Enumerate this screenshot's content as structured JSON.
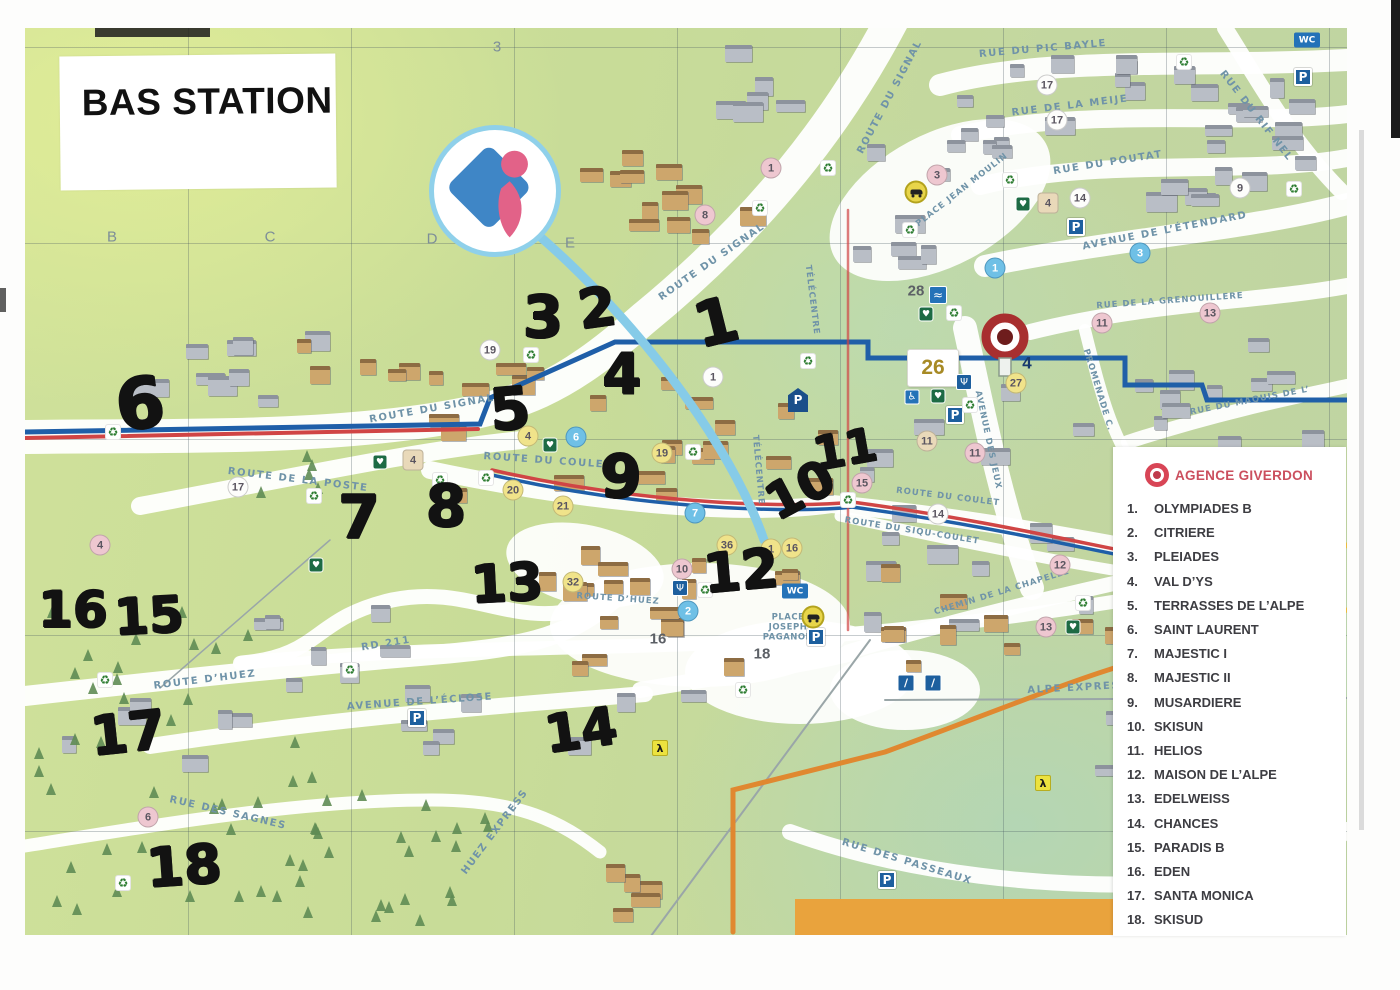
{
  "title": "BAS STATION",
  "legend": {
    "agency_name": "AGENCE GIVERDON",
    "accent_color": "#cb4f5e",
    "items": [
      {
        "num": "1.",
        "label": "OLYMPIADES B"
      },
      {
        "num": "2.",
        "label": "CITRIERE"
      },
      {
        "num": "3.",
        "label": "PLEIADES"
      },
      {
        "num": "4.",
        "label": "VAL D’YS"
      },
      {
        "num": "5.",
        "label": "TERRASSES DE L’ALPE"
      },
      {
        "num": "6.",
        "label": "SAINT LAURENT"
      },
      {
        "num": "7.",
        "label": "MAJESTIC I"
      },
      {
        "num": "8.",
        "label": "MAJESTIC II"
      },
      {
        "num": "9.",
        "label": "MUSARDIERE"
      },
      {
        "num": "10.",
        "label": "SKISUN"
      },
      {
        "num": "11.",
        "label": "HELIOS"
      },
      {
        "num": "12.",
        "label": "MAISON DE L’ALPE"
      },
      {
        "num": "13.",
        "label": "EDELWEISS"
      },
      {
        "num": "14.",
        "label": "CHANCES"
      },
      {
        "num": "15.",
        "label": "PARADIS B"
      },
      {
        "num": "16.",
        "label": "EDEN"
      },
      {
        "num": "17.",
        "label": "SANTA MONICA"
      },
      {
        "num": "18.",
        "label": "SKISUD"
      }
    ]
  },
  "grid_labels": [
    {
      "t": "3",
      "x": 497,
      "y": 47
    },
    {
      "t": "B",
      "x": 112,
      "y": 237
    },
    {
      "t": "C",
      "x": 270,
      "y": 237
    },
    {
      "t": "D",
      "x": 432,
      "y": 239
    },
    {
      "t": "E",
      "x": 570,
      "y": 243
    }
  ],
  "streets": [
    {
      "name": "ROUTE DU SIGNAL",
      "x": 890,
      "y": 97,
      "rot": -62
    },
    {
      "name": "ROUTE DU SIGNAL",
      "x": 712,
      "y": 262,
      "rot": -35
    },
    {
      "name": "ROUTE DU SIGNAL",
      "x": 432,
      "y": 409,
      "rot": -10
    },
    {
      "name": "RUE DU PIC BAYLE",
      "x": 1043,
      "y": 49,
      "rot": -5
    },
    {
      "name": "RUE DE LA MEIJE",
      "x": 1070,
      "y": 106,
      "rot": -7
    },
    {
      "name": "RUE DU POUTAT",
      "x": 1108,
      "y": 163,
      "rot": -9
    },
    {
      "name": "RUE DU RIF NEL",
      "x": 1256,
      "y": 116,
      "rot": 52
    },
    {
      "name": "AVENUE DE L’ÉTENDARD",
      "x": 1165,
      "y": 231,
      "rot": -11
    },
    {
      "name": "PLACE JEAN MOULIN",
      "x": 962,
      "y": 190,
      "rot": -38,
      "small": true
    },
    {
      "name": "RUE DE LA GRENOUILLERE",
      "x": 1170,
      "y": 301,
      "rot": -4,
      "small": true
    },
    {
      "name": "PROMENADE C.",
      "x": 1098,
      "y": 390,
      "rot": 73,
      "small": true
    },
    {
      "name": "RUE DU MAQUIS DE L’",
      "x": 1250,
      "y": 401,
      "rot": -11,
      "small": true
    },
    {
      "name": "AVENUE DES JEUX",
      "x": 988,
      "y": 440,
      "rot": 78,
      "small": true
    },
    {
      "name": "TÉLÉCENTRE",
      "x": 812,
      "y": 300,
      "rot": 83,
      "small": true
    },
    {
      "name": "TÉLÉCENTRE",
      "x": 758,
      "y": 470,
      "rot": 85,
      "small": true
    },
    {
      "name": "ROUTE DU COULET",
      "x": 548,
      "y": 461,
      "rot": 4
    },
    {
      "name": "ROUTE DU COULET",
      "x": 948,
      "y": 497,
      "rot": 7,
      "small": true
    },
    {
      "name": "ROUTE DU SIQU-COULET",
      "x": 912,
      "y": 531,
      "rot": 9,
      "small": true
    },
    {
      "name": "CHEMIN DE LA CHAPELLE",
      "x": 1002,
      "y": 592,
      "rot": -17,
      "small": true
    },
    {
      "name": "ROUTE DE LA POSTE",
      "x": 298,
      "y": 480,
      "rot": 7
    },
    {
      "name": "ROUTE D’HUEZ",
      "x": 205,
      "y": 680,
      "rot": -7
    },
    {
      "name": "ROUTE D’HUEZ",
      "x": 618,
      "y": 599,
      "rot": 4,
      "small": true
    },
    {
      "name": "RD 211",
      "x": 386,
      "y": 644,
      "rot": -9
    },
    {
      "name": "AVENUE DE L’ÉCLOSE",
      "x": 420,
      "y": 702,
      "rot": -4
    },
    {
      "name": "RUE DES SAGNES",
      "x": 228,
      "y": 813,
      "rot": 13
    },
    {
      "name": "HUEZ EXPRESS",
      "x": 495,
      "y": 832,
      "rot": -53
    },
    {
      "name": "ALPE EXPRESS",
      "x": 1078,
      "y": 688,
      "rot": -3
    },
    {
      "name": "RUE DES PASSEAUX",
      "x": 907,
      "y": 862,
      "rot": 17
    },
    {
      "name": "PLACE JOSEPH PAGANON",
      "x": 788,
      "y": 628,
      "rot": 0,
      "small": true,
      "wrap": true
    }
  ],
  "handwritten_numbers": [
    {
      "n": "3",
      "x": 543,
      "y": 317,
      "size": 58,
      "rot": 0
    },
    {
      "n": "2",
      "x": 597,
      "y": 308,
      "size": 54,
      "rot": -8
    },
    {
      "n": "1",
      "x": 716,
      "y": 322,
      "size": 62,
      "rot": -14
    },
    {
      "n": "4",
      "x": 622,
      "y": 375,
      "size": 56,
      "rot": 0
    },
    {
      "n": "5",
      "x": 510,
      "y": 409,
      "size": 58,
      "rot": -5
    },
    {
      "n": "6",
      "x": 140,
      "y": 404,
      "size": 70,
      "rot": -8
    },
    {
      "n": "9",
      "x": 621,
      "y": 477,
      "size": 60,
      "rot": 0
    },
    {
      "n": "7",
      "x": 359,
      "y": 518,
      "size": 60,
      "rot": 0
    },
    {
      "n": "8",
      "x": 446,
      "y": 506,
      "size": 58,
      "rot": 0
    },
    {
      "n": "10",
      "x": 800,
      "y": 490,
      "size": 50,
      "rot": -28
    },
    {
      "n": "11",
      "x": 845,
      "y": 449,
      "size": 46,
      "rot": -10
    },
    {
      "n": "12",
      "x": 741,
      "y": 571,
      "size": 54,
      "rot": -5
    },
    {
      "n": "13",
      "x": 507,
      "y": 584,
      "size": 52,
      "rot": -3
    },
    {
      "n": "16",
      "x": 73,
      "y": 610,
      "size": 50,
      "rot": 0
    },
    {
      "n": "15",
      "x": 149,
      "y": 616,
      "size": 50,
      "rot": -3
    },
    {
      "n": "17",
      "x": 128,
      "y": 733,
      "size": 54,
      "rot": -6
    },
    {
      "n": "14",
      "x": 581,
      "y": 731,
      "size": 52,
      "rot": -8
    },
    {
      "n": "18",
      "x": 184,
      "y": 866,
      "size": 54,
      "rot": -4
    }
  ],
  "markers": [
    {
      "n": "4",
      "x": 528,
      "y": 436,
      "s": "y"
    },
    {
      "n": "19",
      "x": 662,
      "y": 453,
      "s": "y"
    },
    {
      "n": "20",
      "x": 513,
      "y": 490,
      "s": "y"
    },
    {
      "n": "21",
      "x": 563,
      "y": 506,
      "s": "y"
    },
    {
      "n": "36",
      "x": 727,
      "y": 545,
      "s": "y"
    },
    {
      "n": "1",
      "x": 771,
      "y": 549,
      "s": "y"
    },
    {
      "n": "16",
      "x": 792,
      "y": 548,
      "s": "y"
    },
    {
      "n": "27",
      "x": 1016,
      "y": 383,
      "s": "y"
    },
    {
      "n": "32",
      "x": 573,
      "y": 582,
      "s": "y"
    },
    {
      "n": "8",
      "x": 705,
      "y": 215,
      "s": "p"
    },
    {
      "n": "1",
      "x": 771,
      "y": 168,
      "s": "p"
    },
    {
      "n": "3",
      "x": 937,
      "y": 175,
      "s": "p"
    },
    {
      "n": "4",
      "x": 100,
      "y": 545,
      "s": "p"
    },
    {
      "n": "10",
      "x": 682,
      "y": 569,
      "s": "p"
    },
    {
      "n": "11",
      "x": 975,
      "y": 453,
      "s": "p"
    },
    {
      "n": "12",
      "x": 1060,
      "y": 565,
      "s": "p"
    },
    {
      "n": "13",
      "x": 1046,
      "y": 627,
      "s": "p"
    },
    {
      "n": "13",
      "x": 1210,
      "y": 313,
      "s": "p"
    },
    {
      "n": "11",
      "x": 1102,
      "y": 323,
      "s": "p"
    },
    {
      "n": "15",
      "x": 862,
      "y": 483,
      "s": "p"
    },
    {
      "n": "6",
      "x": 148,
      "y": 817,
      "s": "p"
    },
    {
      "n": "17",
      "x": 238,
      "y": 487,
      "s": "w"
    },
    {
      "n": "4",
      "x": 413,
      "y": 460,
      "s": "tsq"
    },
    {
      "n": "4",
      "x": 1048,
      "y": 203,
      "s": "tsq"
    },
    {
      "n": "11",
      "x": 927,
      "y": 441,
      "s": "t"
    },
    {
      "n": "14",
      "x": 938,
      "y": 514,
      "s": "w"
    },
    {
      "n": "1",
      "x": 995,
      "y": 268,
      "s": "b"
    },
    {
      "n": "3",
      "x": 1140,
      "y": 253,
      "s": "b"
    },
    {
      "n": "6",
      "x": 576,
      "y": 437,
      "s": "b"
    },
    {
      "n": "2",
      "x": 688,
      "y": 611,
      "s": "b"
    },
    {
      "n": "7",
      "x": 695,
      "y": 513,
      "s": "b"
    },
    {
      "n": "19",
      "x": 490,
      "y": 350,
      "s": "w"
    },
    {
      "n": "17",
      "x": 1047,
      "y": 85,
      "s": "w"
    },
    {
      "n": "17",
      "x": 1057,
      "y": 120,
      "s": "w"
    },
    {
      "n": "14",
      "x": 1080,
      "y": 198,
      "s": "w"
    },
    {
      "n": "9",
      "x": 1240,
      "y": 188,
      "s": "w"
    },
    {
      "n": "1",
      "x": 713,
      "y": 377,
      "s": "w"
    },
    {
      "n": "28",
      "x": 916,
      "y": 291,
      "s": "g"
    },
    {
      "n": "16",
      "x": 658,
      "y": 639,
      "s": "g"
    },
    {
      "n": "18",
      "x": 762,
      "y": 654,
      "s": "g"
    },
    {
      "n": "4",
      "x": 1027,
      "y": 363,
      "s": "navy"
    },
    {
      "n": "26",
      "x": 933,
      "y": 368,
      "s": "sign"
    }
  ],
  "icons": [
    {
      "type": "parking",
      "glyph": "P",
      "x": 1303,
      "y": 77
    },
    {
      "type": "parking",
      "glyph": "P",
      "x": 1076,
      "y": 227
    },
    {
      "type": "parking",
      "glyph": "P",
      "x": 955,
      "y": 415
    },
    {
      "type": "parking",
      "glyph": "P",
      "x": 816,
      "y": 637
    },
    {
      "type": "parking",
      "glyph": "P",
      "x": 417,
      "y": 718
    },
    {
      "type": "parking",
      "glyph": "P",
      "x": 887,
      "y": 880
    },
    {
      "type": "parking-sign",
      "glyph": "P",
      "x": 798,
      "y": 400
    },
    {
      "type": "wc",
      "glyph": "WC",
      "x": 1307,
      "y": 40
    },
    {
      "type": "wc",
      "glyph": "WC",
      "x": 795,
      "y": 591
    },
    {
      "type": "recycle",
      "glyph": "♻",
      "x": 113,
      "y": 432
    },
    {
      "type": "recycle",
      "glyph": "♻",
      "x": 314,
      "y": 496
    },
    {
      "type": "recycle",
      "glyph": "♻",
      "x": 440,
      "y": 480
    },
    {
      "type": "recycle",
      "glyph": "♻",
      "x": 531,
      "y": 355
    },
    {
      "type": "recycle",
      "glyph": "♻",
      "x": 486,
      "y": 478
    },
    {
      "type": "recycle",
      "glyph": "♻",
      "x": 828,
      "y": 168
    },
    {
      "type": "recycle",
      "glyph": "♻",
      "x": 760,
      "y": 208
    },
    {
      "type": "recycle",
      "glyph": "♻",
      "x": 910,
      "y": 230
    },
    {
      "type": "recycle",
      "glyph": "♻",
      "x": 1184,
      "y": 62
    },
    {
      "type": "recycle",
      "glyph": "♻",
      "x": 1294,
      "y": 189
    },
    {
      "type": "recycle",
      "glyph": "♻",
      "x": 1010,
      "y": 180
    },
    {
      "type": "recycle",
      "glyph": "♻",
      "x": 954,
      "y": 313
    },
    {
      "type": "recycle",
      "glyph": "♻",
      "x": 970,
      "y": 405
    },
    {
      "type": "recycle",
      "glyph": "♻",
      "x": 1083,
      "y": 603
    },
    {
      "type": "recycle",
      "glyph": "♻",
      "x": 848,
      "y": 500
    },
    {
      "type": "recycle",
      "glyph": "♻",
      "x": 705,
      "y": 590
    },
    {
      "type": "recycle",
      "glyph": "♻",
      "x": 743,
      "y": 690
    },
    {
      "type": "recycle",
      "glyph": "♻",
      "x": 350,
      "y": 670
    },
    {
      "type": "recycle",
      "glyph": "♻",
      "x": 105,
      "y": 680
    },
    {
      "type": "recycle",
      "glyph": "♻",
      "x": 123,
      "y": 883
    },
    {
      "type": "recycle",
      "glyph": "♻",
      "x": 693,
      "y": 452
    },
    {
      "type": "recycle",
      "glyph": "♻",
      "x": 808,
      "y": 361
    },
    {
      "type": "defib",
      "glyph": "♥",
      "x": 380,
      "y": 462
    },
    {
      "type": "defib",
      "glyph": "♥",
      "x": 550,
      "y": 445
    },
    {
      "type": "defib",
      "glyph": "♥",
      "x": 1023,
      "y": 204
    },
    {
      "type": "defib",
      "glyph": "♥",
      "x": 926,
      "y": 314
    },
    {
      "type": "defib",
      "glyph": "♥",
      "x": 938,
      "y": 396
    },
    {
      "type": "defib",
      "glyph": "♥",
      "x": 1073,
      "y": 627
    },
    {
      "type": "defib",
      "glyph": "♥",
      "x": 316,
      "y": 565
    },
    {
      "type": "plug",
      "glyph": "Ψ",
      "x": 680,
      "y": 588
    },
    {
      "type": "plug",
      "glyph": "Ψ",
      "x": 964,
      "y": 382
    },
    {
      "type": "pool",
      "glyph": "≈",
      "x": 938,
      "y": 295
    },
    {
      "type": "wheelchair",
      "glyph": "♿",
      "x": 912,
      "y": 397
    },
    {
      "type": "skate",
      "glyph": "/",
      "x": 906,
      "y": 683
    },
    {
      "type": "sledge",
      "glyph": "/",
      "x": 933,
      "y": 683
    },
    {
      "type": "car",
      "glyph": "",
      "x": 916,
      "y": 192
    },
    {
      "type": "car",
      "glyph": "",
      "x": 813,
      "y": 617
    },
    {
      "type": "hiker",
      "glyph": "λ",
      "x": 660,
      "y": 748
    },
    {
      "type": "hiker",
      "glyph": "λ",
      "x": 1043,
      "y": 783
    }
  ],
  "colors": {
    "map_green": "#c8dc98",
    "road_white": "#ffffff",
    "street_label": "#6f93a8",
    "marker_yellow": "#f0e38a",
    "marker_pink": "#eec7d0",
    "marker_blue": "#6fc0e6",
    "handwriting": "#121212",
    "agency_red": "#cb4f5e",
    "pin_red": "#a82f2f",
    "cable_blue": "#86cbe8",
    "route_navy": "#1f5fa8",
    "route_red": "#d04545",
    "route_orange": "#e08830",
    "route_yellow": "#f0c040",
    "banner_orange": "#e9a33d"
  }
}
